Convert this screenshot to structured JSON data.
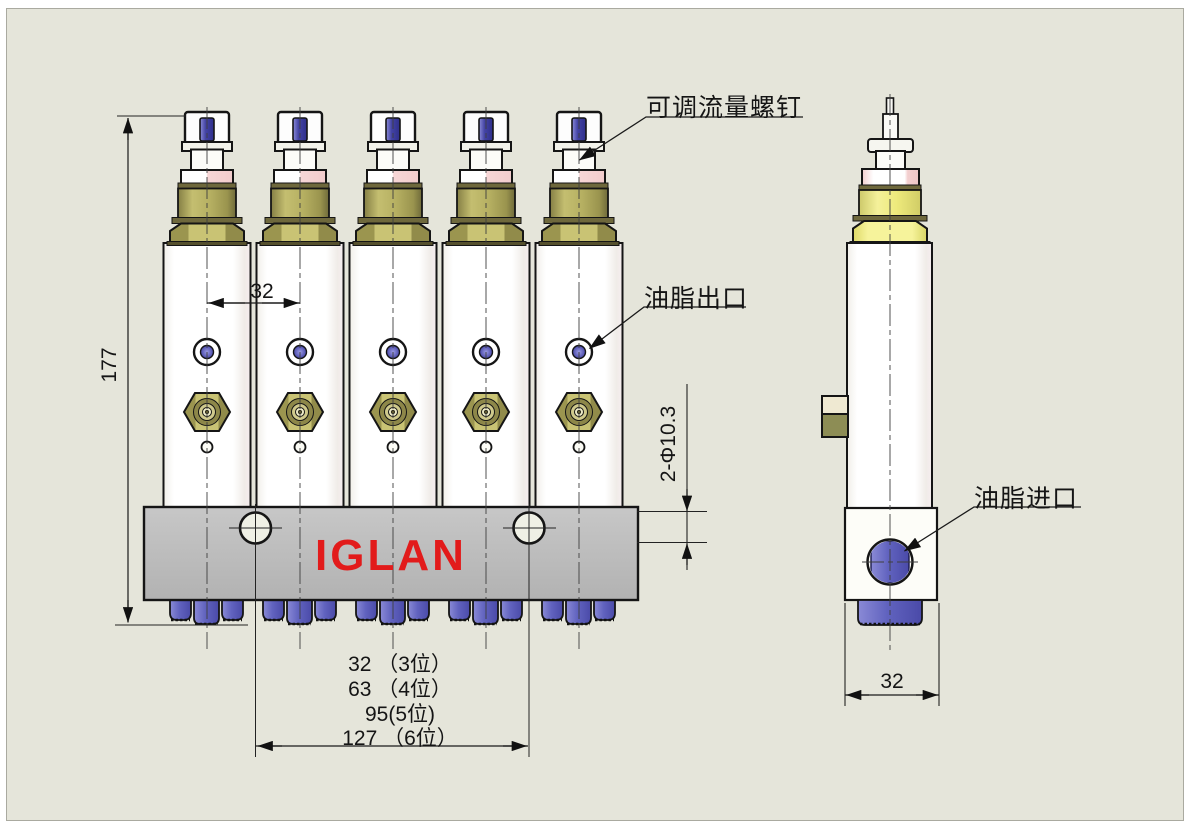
{
  "brand": {
    "logo_text": "IGLAN",
    "logo_color": "#e21b1b"
  },
  "callouts": {
    "adjustable_flow_screw": "可调流量螺钉",
    "grease_outlet": "油脂出口",
    "grease_inlet": "油脂进口"
  },
  "dimensions": {
    "total_height": "177",
    "station_pitch": "32",
    "mounting_holes": "2-Φ10.3",
    "side_width": "32",
    "hole_spacing_options": [
      "32 （3位）",
      "63 （4位）",
      "95(5位)",
      "127 （6位）"
    ]
  },
  "colors": {
    "background": "#e5e5da",
    "manifold_gray": "#bcbcbc",
    "brass_olive": "#b2ac5c",
    "side_yellow": "#f0ed86",
    "port_blue": "#6466c2",
    "logo_red": "#e21b1b"
  }
}
